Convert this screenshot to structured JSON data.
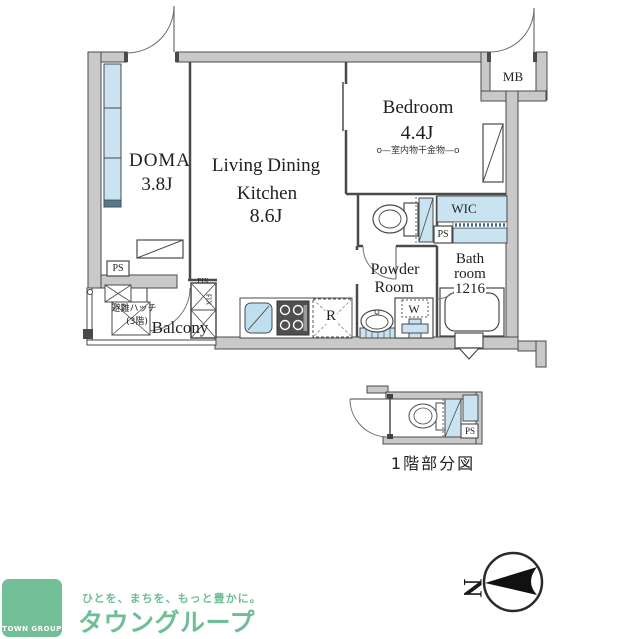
{
  "plan": {
    "rooms": {
      "doma": {
        "name": "DOMA",
        "size": "3.8J"
      },
      "ldk": {
        "line1": "Living Dining",
        "line2": "Kitchen",
        "size": "8.6J"
      },
      "bedroom": {
        "name": "Bedroom",
        "size": "4.4J",
        "note": "o—室内物干金物—o"
      },
      "wic": {
        "name": "WIC"
      },
      "powder": {
        "line1": "Powder",
        "line2": "Room"
      },
      "bath": {
        "line1": "Bath",
        "line2": "room",
        "line3": "1216"
      },
      "balcony": {
        "name": "Balcony"
      }
    },
    "marks": {
      "mb": "MB",
      "ps": "PS",
      "fridge": "R",
      "washer": "W",
      "fix": "FIX",
      "hatch_line1": "避難ハッチ",
      "hatch_line2": "(3階)"
    },
    "caption_1f": "1階部分図",
    "compass": {
      "letter": "N"
    }
  },
  "branding": {
    "logo_square_text": "TOWN GROUP",
    "tagline": "ひとを、まちを、もっと豊かに。",
    "company": "タウングループ"
  },
  "colors": {
    "brand_green": "#72BE96",
    "floor_blue": "#C9E3F1",
    "wall_gray": "#C9C9C9"
  }
}
